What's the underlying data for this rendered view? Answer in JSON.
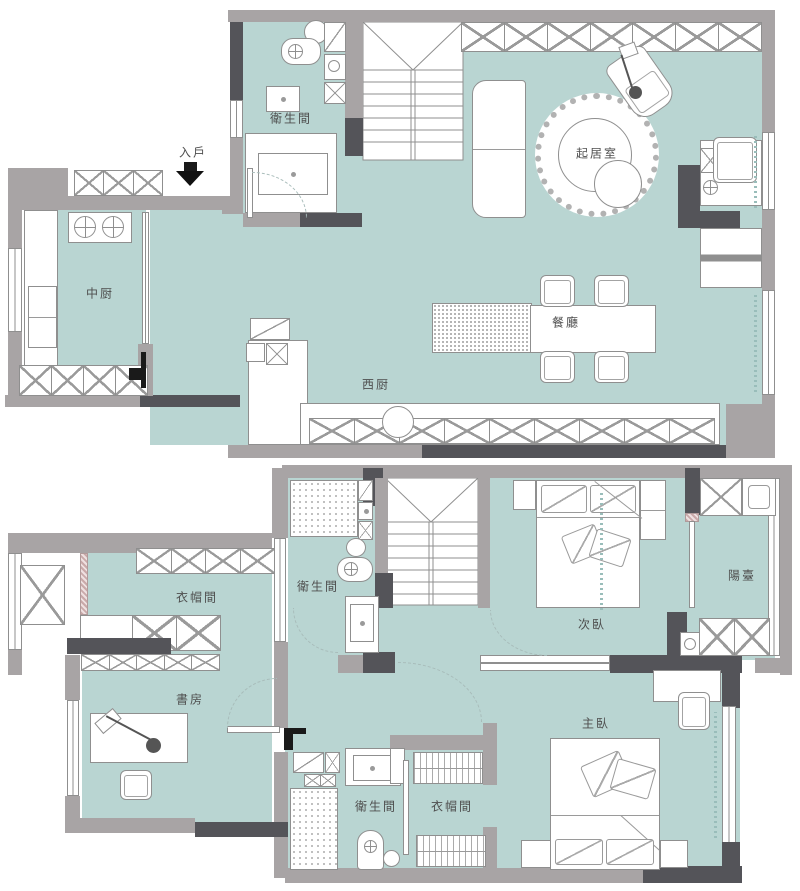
{
  "document": {
    "type": "two-storey apartment floor plan"
  },
  "colors": {
    "floor_fill": "#b9d5d2",
    "wall_gray": "#a8a4a5",
    "wall_dark": "#545459",
    "outline": "#8f8f8f",
    "label_text": "#4e4e4e"
  },
  "floors": {
    "upper": {
      "name": "upper-floor-plan",
      "rooms": [
        {
          "id": "entry",
          "label": "入戶"
        },
        {
          "id": "bathroom",
          "label": "衛生間"
        },
        {
          "id": "chinese-kitchen",
          "label": "中厨"
        },
        {
          "id": "western-kitchen",
          "label": "西厨"
        },
        {
          "id": "living-room",
          "label": "起居室"
        },
        {
          "id": "dining-room",
          "label": "餐廳"
        }
      ]
    },
    "lower": {
      "name": "lower-floor-plan",
      "rooms": [
        {
          "id": "bathroom-north",
          "label": "衛生間"
        },
        {
          "id": "cloakroom-north",
          "label": "衣帽間"
        },
        {
          "id": "study",
          "label": "書房"
        },
        {
          "id": "secondary-bedroom",
          "label": "次臥"
        },
        {
          "id": "balcony",
          "label": "陽臺"
        },
        {
          "id": "master-bedroom",
          "label": "主臥"
        },
        {
          "id": "bathroom-south",
          "label": "衛生間"
        },
        {
          "id": "cloakroom-south",
          "label": "衣帽間"
        }
      ]
    }
  }
}
